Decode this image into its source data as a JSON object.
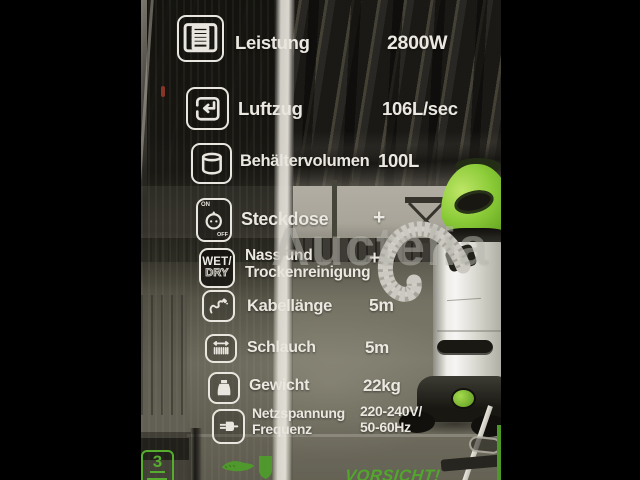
{
  "photo": {
    "watermark": "Auctelia",
    "spec_panel": {
      "rows": [
        {
          "icon": "motor-icon",
          "label": "Leistung",
          "value": "2800W"
        },
        {
          "icon": "airflow-icon",
          "label": "Luftzug",
          "value": "106L/sec"
        },
        {
          "icon": "container-icon",
          "label": "Behältervolumen",
          "value": "100L"
        },
        {
          "icon": "power-socket-icon",
          "label": "Steckdose",
          "value": "+",
          "icon_text_on": "ON",
          "icon_text_off": "OFF"
        },
        {
          "icon": "wet-dry-icon",
          "label": "Nass und\nTrockenreinigung",
          "value": "+",
          "icon_text_wet": "WET/",
          "icon_text_dry": "DRY"
        },
        {
          "icon": "cable-icon",
          "label": "Kabellänge",
          "value": "5m"
        },
        {
          "icon": "hose-icon",
          "label": "Schlauch",
          "value": "5m"
        },
        {
          "icon": "weight-icon",
          "label": "Gewicht",
          "value": "22kg"
        },
        {
          "icon": "plug-icon",
          "label": "Netzspannung\nFrequenz",
          "value": "220-240V/\n50-60Hz"
        }
      ]
    },
    "box_markings": {
      "stacking_layers": "3",
      "warning": "VORSICHT!"
    },
    "colors": {
      "spec_text": "#f3f2ea",
      "marking_green": "#55b32c",
      "vacuum_lid_green": "#8ed338"
    }
  }
}
